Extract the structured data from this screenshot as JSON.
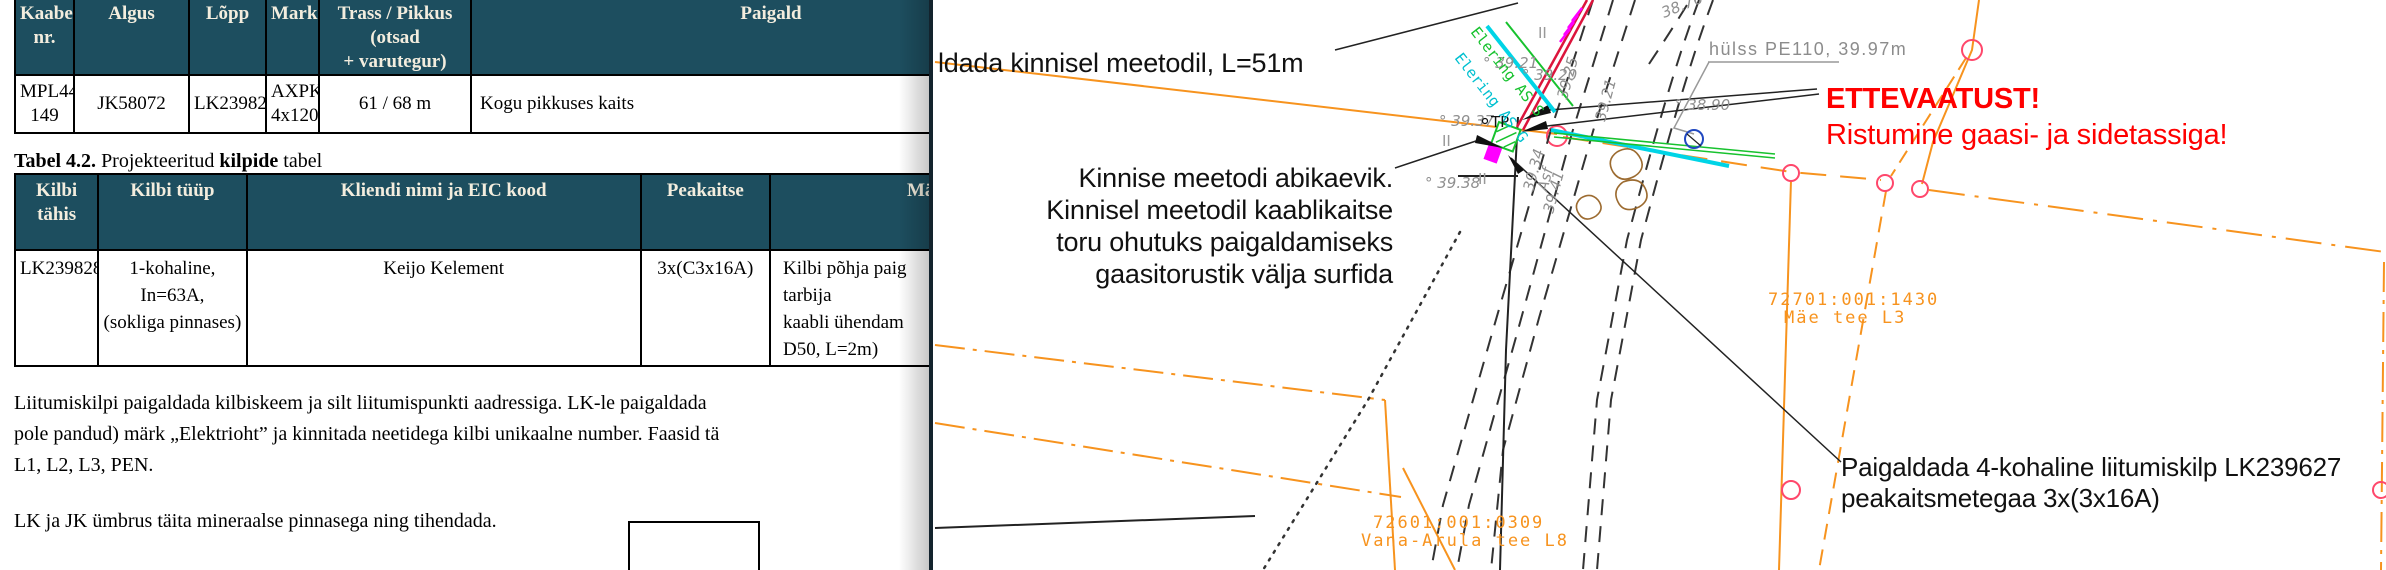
{
  "document": {
    "table41": {
      "headers": [
        "Kaabel\nnr.",
        "Algus",
        "Lõpp",
        "Mark",
        "Trass / Pikkus (otsad\n+ varutegur)",
        "Paigald"
      ],
      "row": [
        "MPL446\n149",
        "JK58072",
        "LK239828",
        "AXPK\n4x120",
        "61 / 68 m",
        "Kogu pikkuses kaits"
      ]
    },
    "caption42": {
      "b1": "Tabel 4.2.",
      "t1": " Projekteeritud ",
      "b2": "kilpide",
      "t2": " tabel"
    },
    "table42": {
      "headers": [
        "Kilbi tähis",
        "Kilbi tüüp",
        "Kliendi nimi ja EIC kood",
        "Peakaitse",
        "Mä"
      ],
      "row": [
        "LK239828",
        "1-kohaline, In=63A,\n(sokliga pinnases)",
        "Keijo Kelement",
        "3x(C3x16A)",
        "Kilbi põhja paig\ntarbija\nkaabli ühendam\nD50, L=2m)"
      ]
    },
    "para1": "Liitumiskilpi paigaldada kilbiskeem ja silt liitumispunkti aadressiga. LK-le paigaldada\npole pandud) märk „Elektrioht” ja kinnitada neetidega kilbi unikaalne number. Faasid tä\nL1, L2, L3, PEN.",
    "para2": "LK ja JK ümbrus täita mineraalse pinnasega ning tihendada."
  },
  "map": {
    "note_method": "ldada kinnisel meetodil, L=51m",
    "note_pit": "Kinnise meetodi abikaevik.\nKinnisel meetodil kaablikaitse\ntoru ohutuks paigaldamiseks\ngaasitorustik välja surfida",
    "note_kilp": "Paigaldada 4-kohaline liitumiskilp LK239627\npeakaitsmetegaa 3x(3x16A)",
    "warning_title": "ETTEVAATUST!",
    "warning_body": "Ristumine gaasi- ja sidetassiga!",
    "sleeve": "hülss PE110, 39.97m",
    "cadastre1_code": "72701:001:1430",
    "cadastre1_name": "Mäe tee L3",
    "cadastre2_code": "72601:001:0309",
    "cadastre2_name": "Vana-Arula tee L8",
    "utility_green": "Elering AS S",
    "utility_cyan": "Elering AS G",
    "marker_tp": "TP",
    "marker_ii": "II",
    "elev": {
      "e1": "° 39.21",
      "e2": "° 39.20",
      "e3": "39.25",
      "e4": "39.21",
      "e5": "° 38.90",
      "e6": "38.76",
      "e7": "° 39.37",
      "e8": "° 39.38",
      "e9": "39.41",
      "e10": "39.34",
      "surface": "Asf"
    },
    "colors": {
      "teal_header": "#1d4e5f",
      "orange": "#f7931e",
      "warning_red": "#ff0000",
      "cyan": "#00d4e6",
      "green": "#17c22e",
      "pink_node": "#ff476b",
      "cable_crimson": "#dc143c",
      "magenta": "#ff00ff",
      "crossing_blue": "#2148c0",
      "vegetation_brown": "#9c6b30",
      "cad_gray": "#8f8f8f"
    }
  }
}
